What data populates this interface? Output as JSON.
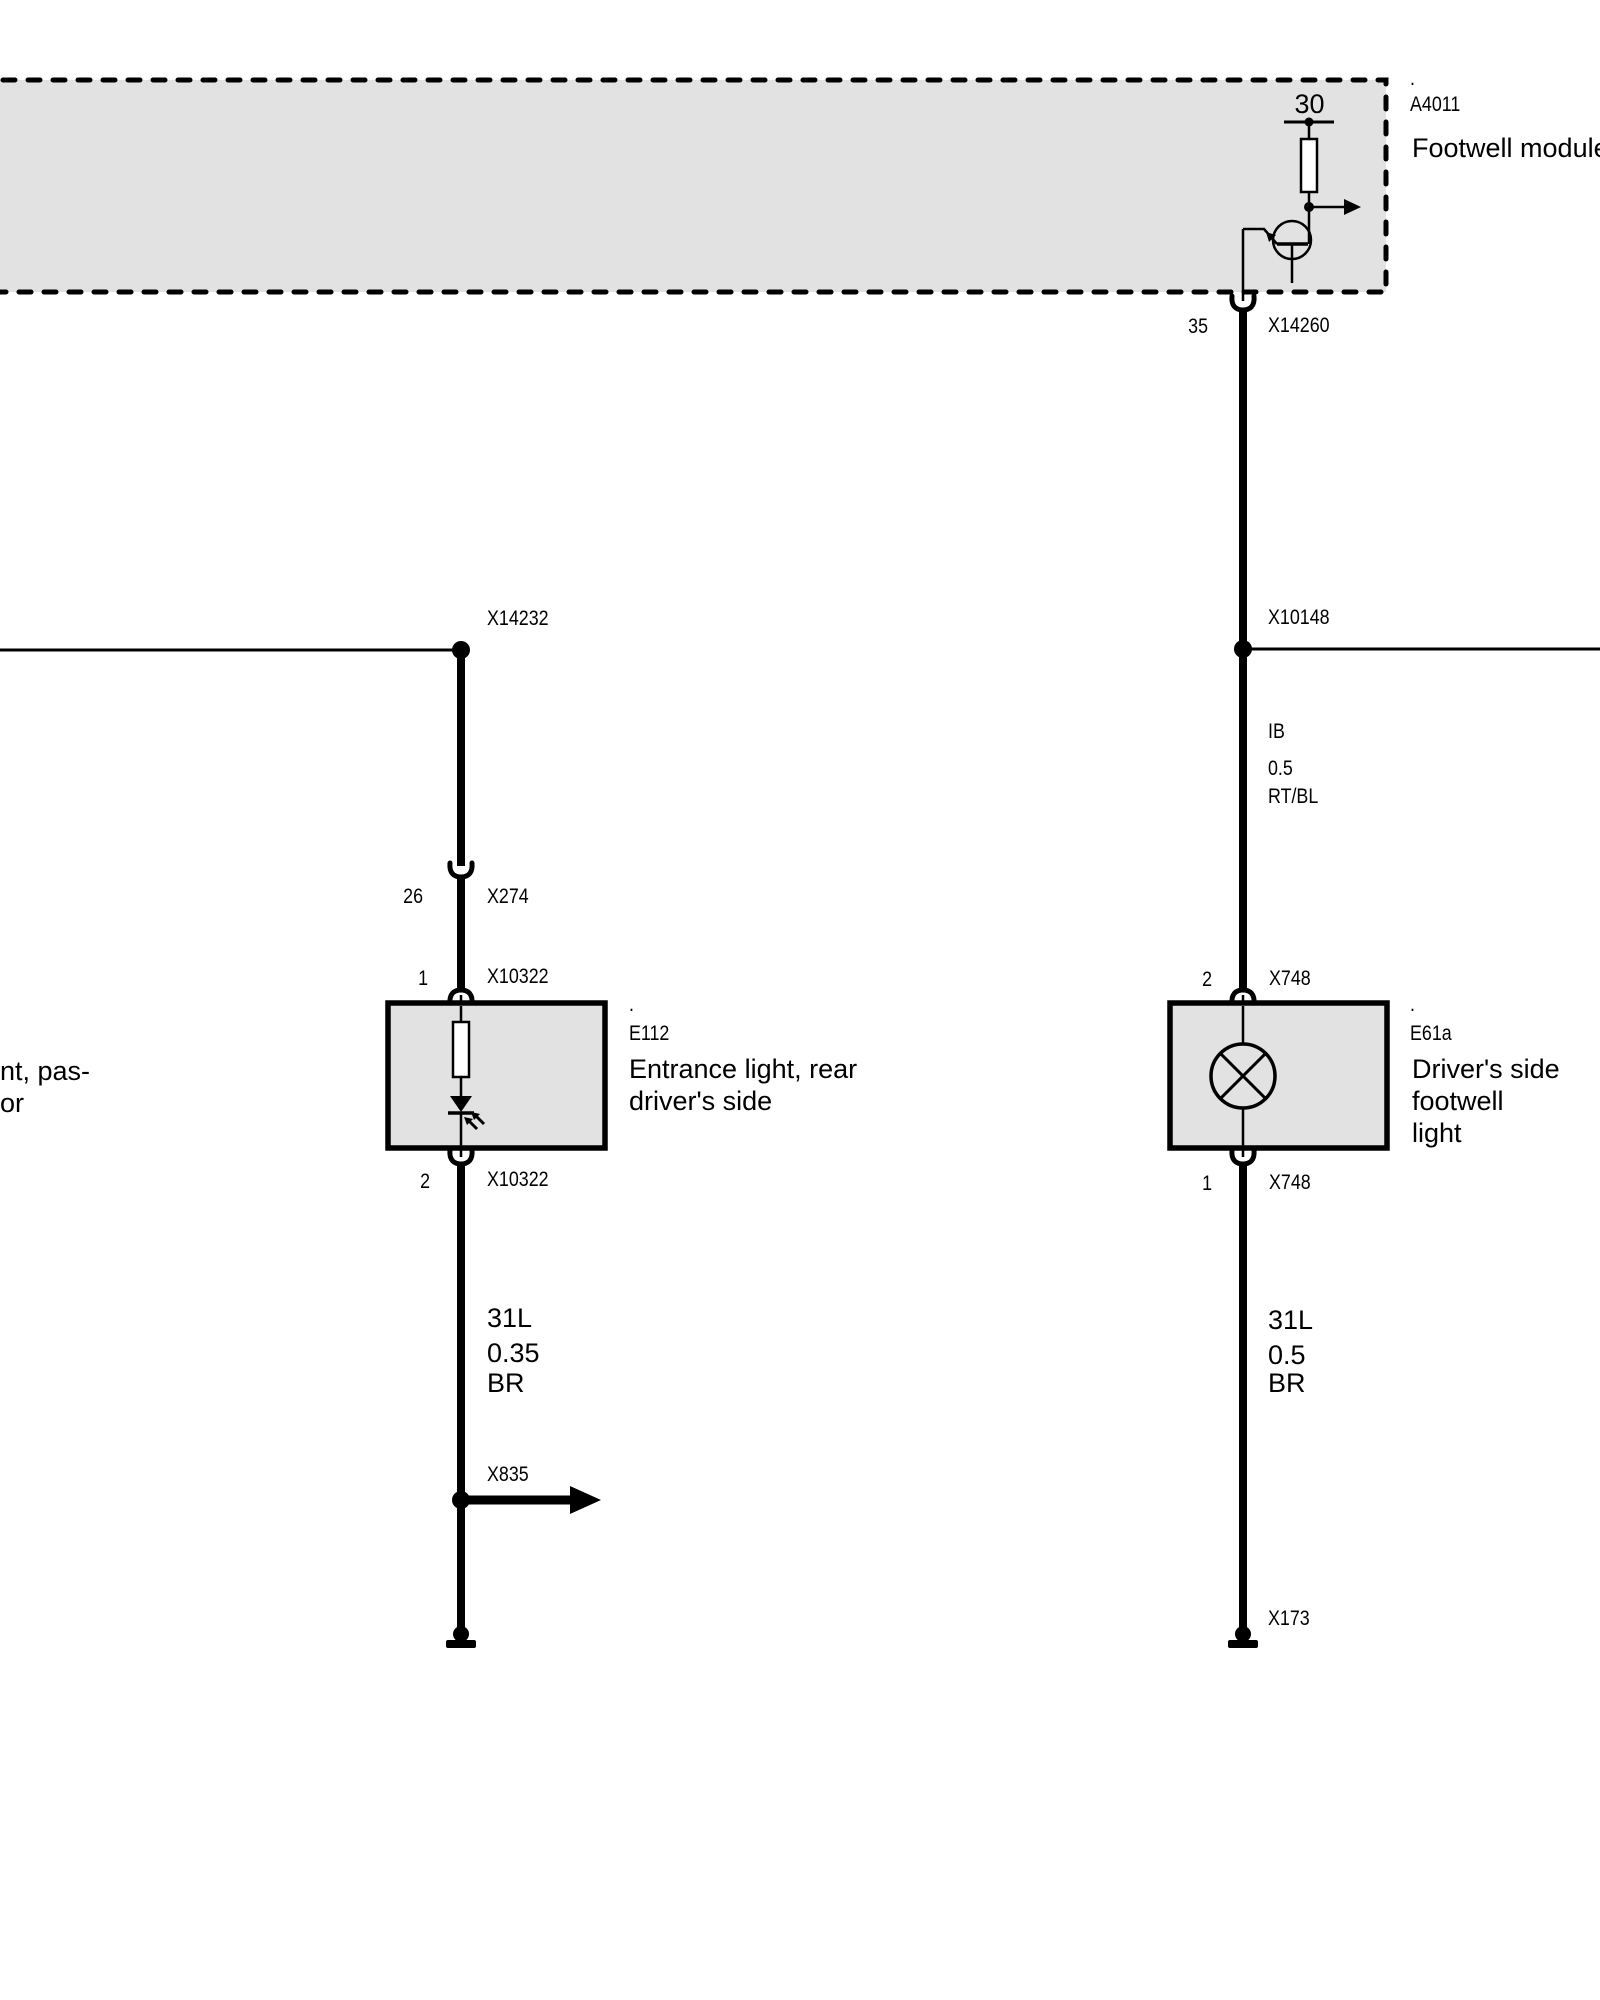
{
  "page": {
    "background": "#ffffff",
    "line_color": "#000000",
    "box_fill": "#e2e2e2",
    "resistor_fill": "#ffffff"
  },
  "footwell_module": {
    "code_dot": ".",
    "code": "A4011",
    "name": "Footwell module",
    "terminal": "30",
    "pin_number": "35",
    "pin_connector": "X14260",
    "symbols": [
      "terminal-30-node",
      "resistor",
      "output-arrow",
      "transistor"
    ]
  },
  "left_circuit": {
    "top_junction_connector": "X14232",
    "inline_connector": {
      "pin_number": "26",
      "label": "X274"
    },
    "component": {
      "code_dot": ".",
      "code": "E112",
      "name": "Entrance light, rear\ndriver's side",
      "top_pin": {
        "pin_number": "1",
        "connector": "X10322"
      },
      "bottom_pin": {
        "pin_number": "2",
        "connector": "X10322"
      },
      "symbols": [
        "resistor",
        "led"
      ]
    },
    "wire_lower": {
      "circuit": "31L",
      "cross_section": "0.35",
      "color_code": "BR"
    },
    "branch_connector": "X835",
    "edge_clipped_label": "nt, pas-\nor",
    "symbols": [
      "junction-dot",
      "connector-socket",
      "branch-arrow",
      "ground"
    ]
  },
  "right_circuit": {
    "junction_connector": "X10148",
    "wire_upper": {
      "circuit": "IB",
      "cross_section": "0.5",
      "color_code": "RT/BL"
    },
    "component": {
      "code_dot": ".",
      "code": "E61a",
      "name": "Driver's side footwell\nlight",
      "top_pin": {
        "pin_number": "2",
        "connector": "X748"
      },
      "bottom_pin": {
        "pin_number": "1",
        "connector": "X748"
      },
      "symbols": [
        "bulb"
      ]
    },
    "wire_lower": {
      "circuit": "31L",
      "cross_section": "0.5",
      "color_code": "BR"
    },
    "ground_connector": "X173",
    "symbols": [
      "junction-dot",
      "connector-socket",
      "ground"
    ]
  }
}
